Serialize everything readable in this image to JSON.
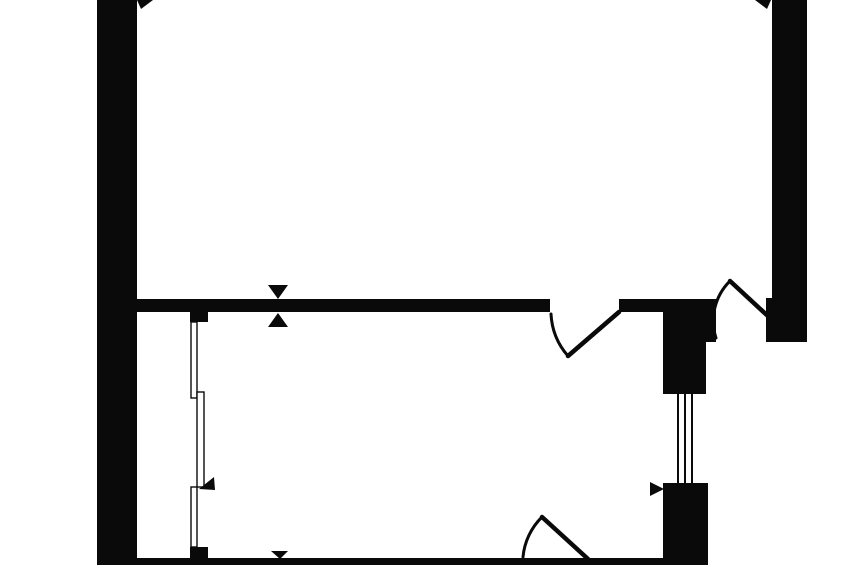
{
  "canvas": {
    "width": 848,
    "height": 565,
    "background": "#ffffff",
    "ink": "#0a0a0a"
  },
  "plan": {
    "kind": "apartment-floor-plan",
    "walls": [
      {
        "name": "left-outer-wall",
        "x": 97,
        "y": 0,
        "w": 40,
        "h": 565
      },
      {
        "name": "right-outer-wall",
        "x": 772,
        "y": 0,
        "w": 35,
        "h": 342
      },
      {
        "name": "entry-door-jamb",
        "x": 766,
        "y": 298,
        "w": 6,
        "h": 44
      },
      {
        "name": "partition-wall-left",
        "x": 136,
        "y": 299,
        "w": 414,
        "h": 13
      },
      {
        "name": "partition-wall-right",
        "x": 619,
        "y": 299,
        "w": 44,
        "h": 13
      },
      {
        "name": "duct-block-top",
        "x": 663,
        "y": 299,
        "w": 53,
        "h": 43
      },
      {
        "name": "duct-column",
        "x": 663,
        "y": 342,
        "w": 43,
        "h": 52
      },
      {
        "name": "duct-block-bottom",
        "x": 663,
        "y": 483,
        "w": 45,
        "h": 82
      },
      {
        "name": "bottom-outer-wall",
        "x": 97,
        "y": 558,
        "w": 611,
        "h": 7
      },
      {
        "name": "window-jamb-top",
        "x": 190,
        "y": 312,
        "w": 18,
        "h": 10
      },
      {
        "name": "window-jamb-bottom",
        "x": 190,
        "y": 547,
        "w": 18,
        "h": 12
      }
    ],
    "windows": [
      {
        "name": "balcony-glazing-upper",
        "x": 191,
        "y": 322,
        "w": 6,
        "h": 76
      },
      {
        "name": "balcony-glazing-middle",
        "x": 197,
        "y": 392,
        "w": 7,
        "h": 95
      },
      {
        "name": "balcony-glazing-lower",
        "x": 191,
        "y": 487,
        "w": 6,
        "h": 60
      }
    ],
    "shaft_lines": [
      {
        "name": "vent-shaft-line-1",
        "x": 677,
        "y": 394,
        "w": 2,
        "h": 89
      },
      {
        "name": "vent-shaft-line-2",
        "x": 684,
        "y": 394,
        "w": 2,
        "h": 89
      },
      {
        "name": "vent-shaft-line-3",
        "x": 691,
        "y": 394,
        "w": 2,
        "h": 89
      }
    ],
    "doors": [
      {
        "name": "interior-door",
        "leaf": {
          "x1": 619,
          "y1": 312,
          "x2": 568,
          "y2": 356
        },
        "arc": "M 551 314 A 69 69 0 0 0 568 356"
      },
      {
        "name": "entry-door",
        "leaf": {
          "x1": 770,
          "y1": 318,
          "x2": 730,
          "y2": 281
        },
        "arc": "M 716 338 A 56 56 0 0 1 730 281"
      },
      {
        "name": "bathroom-door",
        "leaf": {
          "x1": 588,
          "y1": 559,
          "x2": 542,
          "y2": 517
        },
        "arc": "M 523 557 A 64 64 0 0 1 542 517"
      }
    ],
    "markers": [
      {
        "name": "dimension-arrow-top-left-icon",
        "points": "137,0 153,0 141,9"
      },
      {
        "name": "dimension-arrow-top-right-icon",
        "points": "755,0 771,0 767,9"
      },
      {
        "name": "partition-marker-upper-icon",
        "points": "268,285 288,285 278,299"
      },
      {
        "name": "partition-marker-lower-icon",
        "points": "278,313 268,327 288,327"
      },
      {
        "name": "bottom-wall-marker-icon",
        "points": "271,551 288,551 280,559"
      },
      {
        "name": "window-arrow-icon",
        "points": "199,489 214,477 215,490"
      },
      {
        "name": "duct-arrow-icon",
        "points": "650,482 650,496 664,489"
      }
    ]
  }
}
